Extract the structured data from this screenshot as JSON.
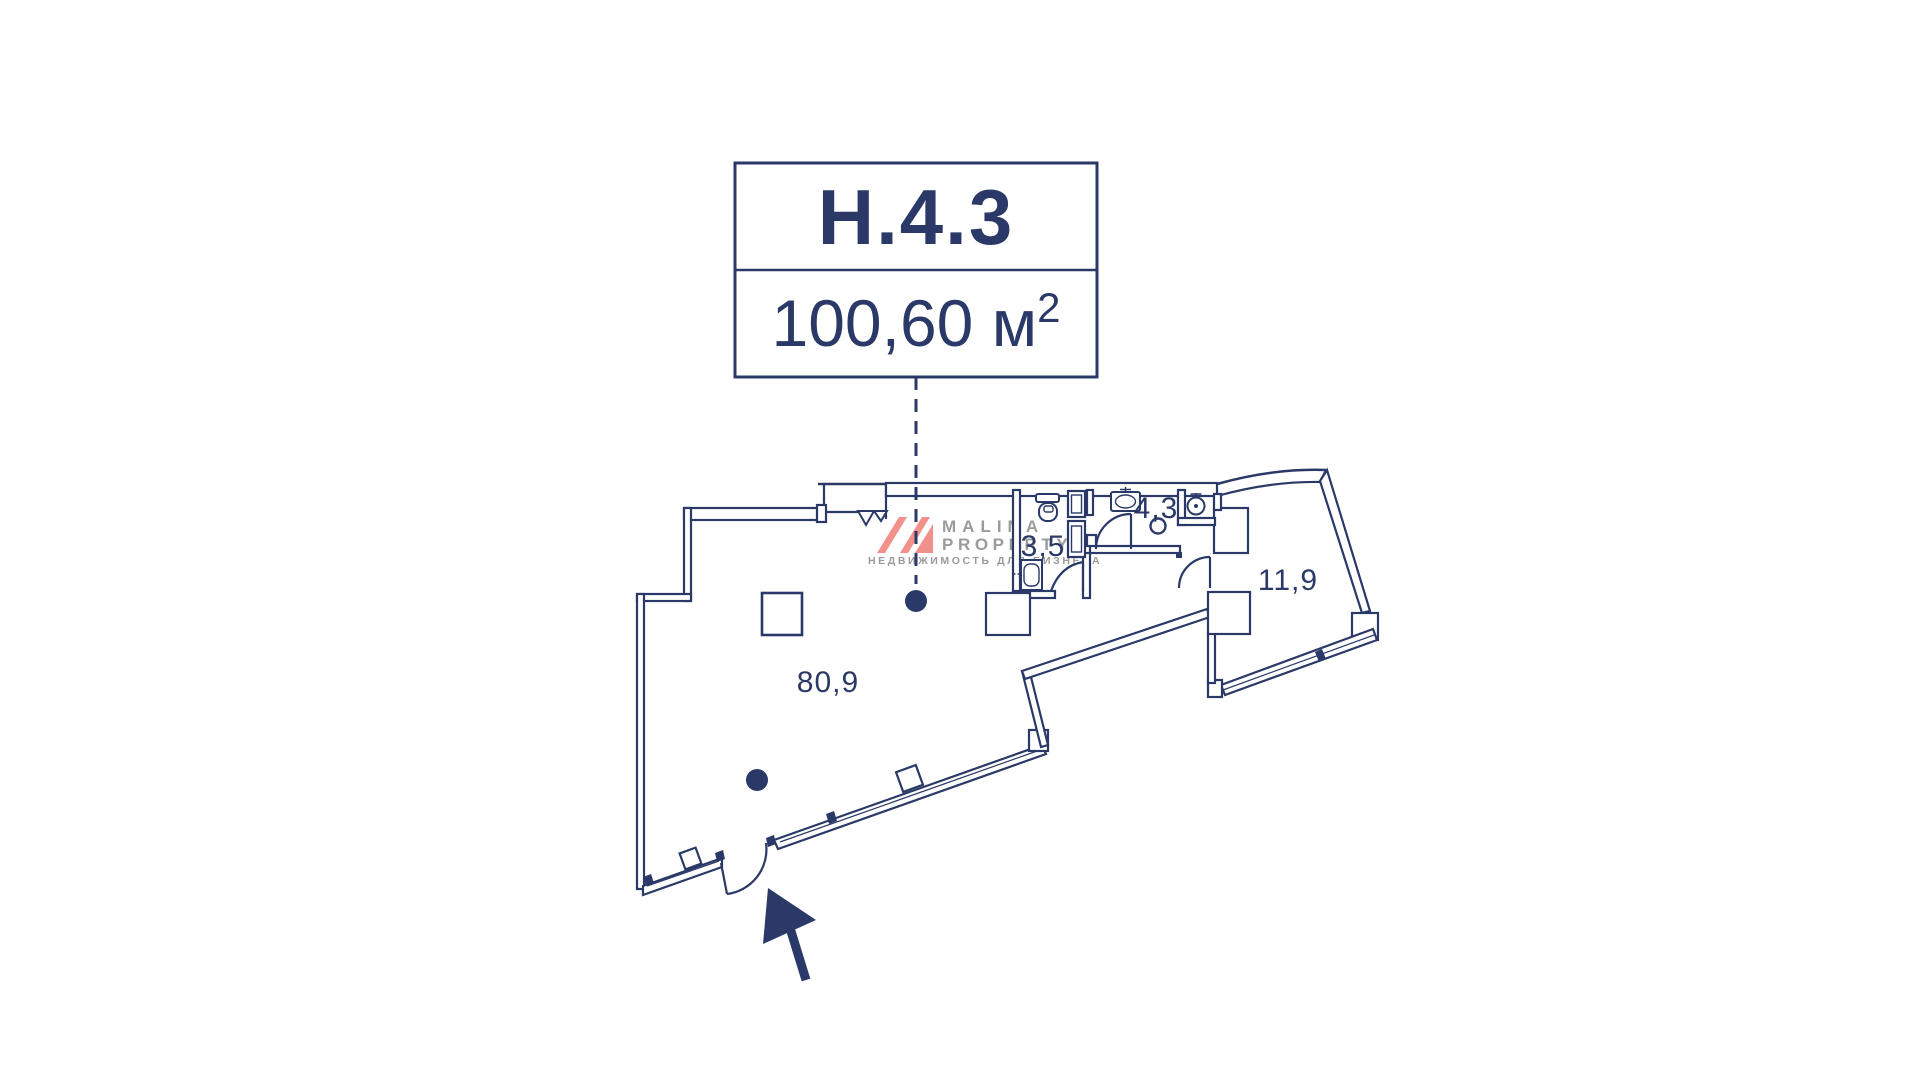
{
  "colors": {
    "line_navy": "#2b3968",
    "watermark_gray": "#9b9b9b",
    "watermark_pink": "#f2918b",
    "background": "#ffffff"
  },
  "title_card": {
    "unit_number": "Н.4.3",
    "area_value": "100,60 м",
    "area_superscript": "2"
  },
  "floor_plan": {
    "rooms": [
      {
        "name": "main-room",
        "area_label": "80,9"
      },
      {
        "name": "bathroom",
        "area_label": "3,5"
      },
      {
        "name": "wc",
        "area_label": "4,3"
      },
      {
        "name": "side-room",
        "area_label": "11,9"
      }
    ]
  },
  "watermark": {
    "brand_line1": "MALINA",
    "brand_line2": "PROPERTY",
    "tagline": "НЕДВИЖИМОСТЬ ДЛЯ БИЗНЕСА"
  }
}
